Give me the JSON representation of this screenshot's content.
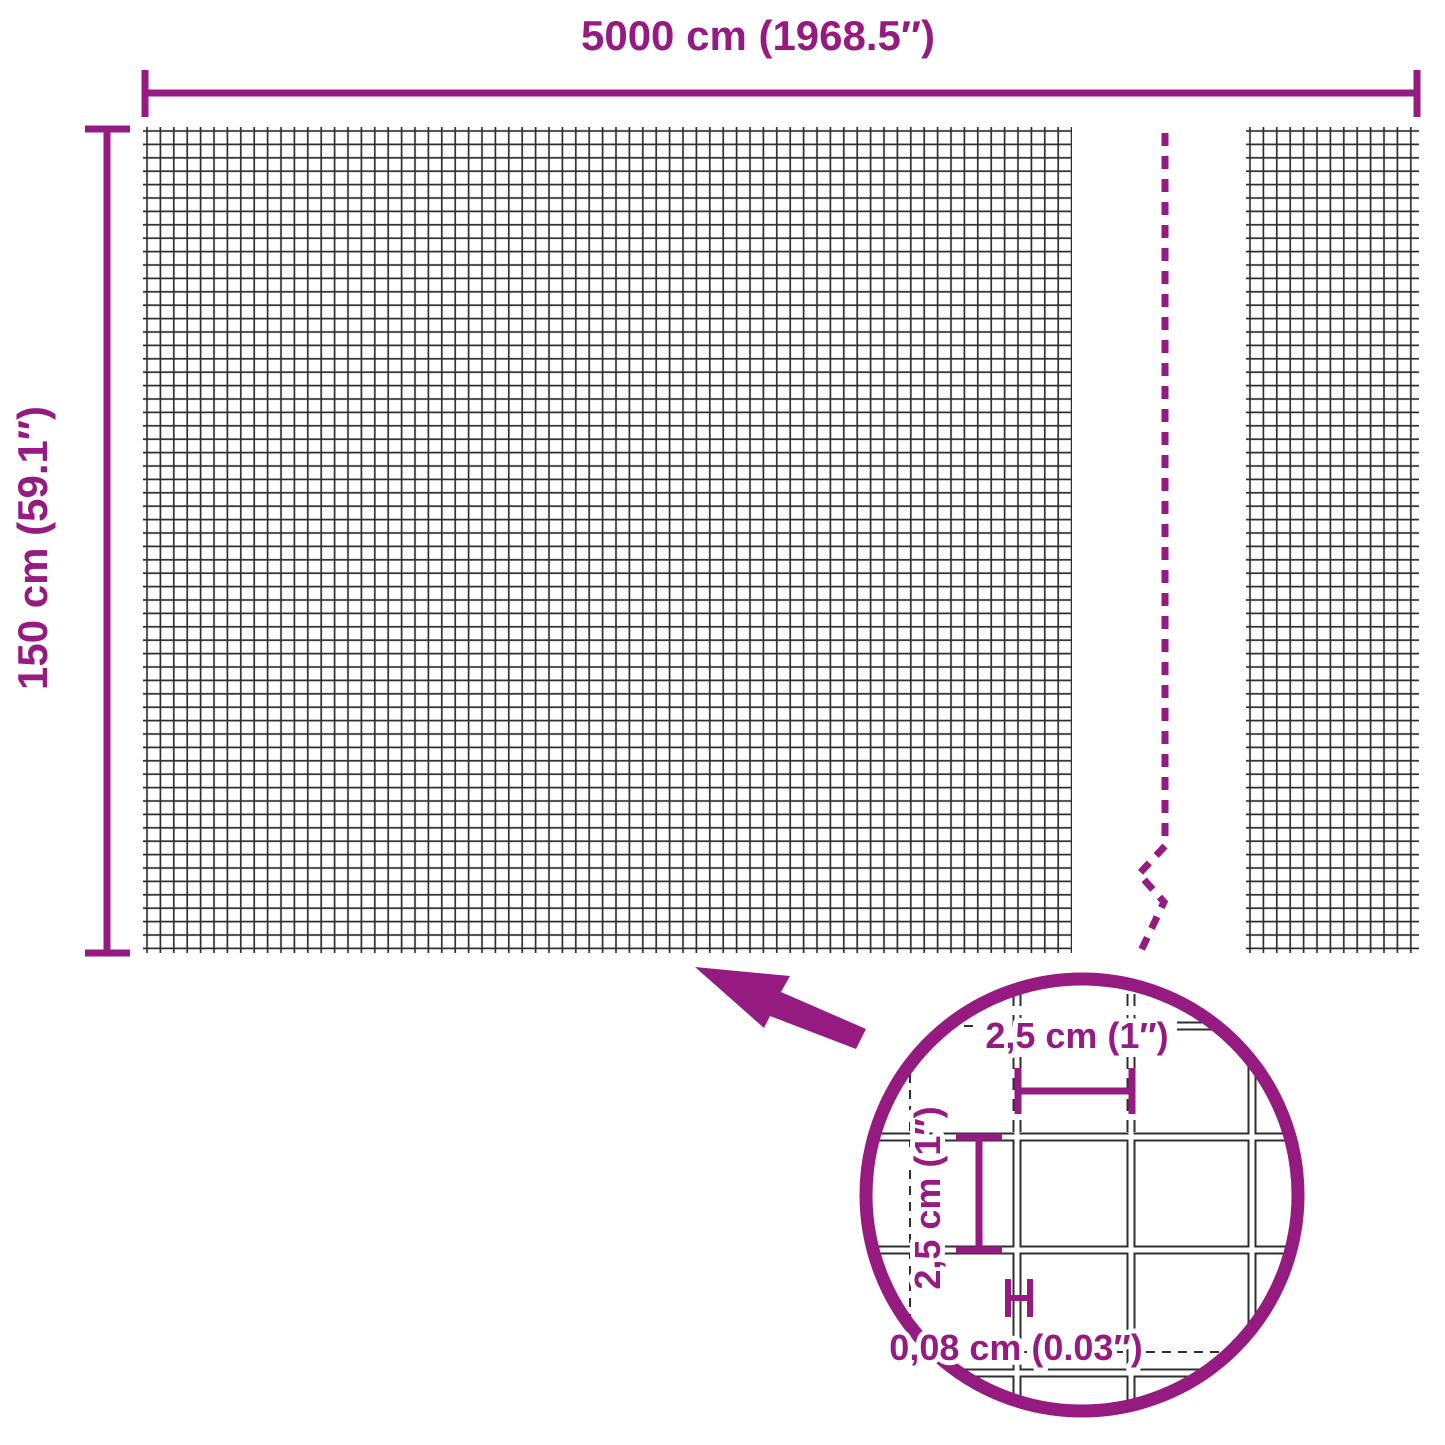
{
  "diagram": {
    "colors": {
      "accent": "#951b81",
      "mesh_line": "#2f2f2f",
      "background": "#ffffff"
    },
    "overall": {
      "width_label": "5000 cm (1968.5″)",
      "height_label": "150 cm (59.1″)"
    },
    "lens": {
      "cell_width_label": "2,5 cm (1″)",
      "cell_height_label": "2,5 cm (1″)",
      "wire_thickness_label": "0,08 cm (0.03″)"
    },
    "measurements": {
      "width_cm": "5000",
      "width_in": "1968.5",
      "height_cm": "150",
      "height_in": "59.1",
      "mesh_cell_cm": "2,5",
      "mesh_cell_in": "1",
      "wire_thickness_cm": "0,08",
      "wire_thickness_in": "0.03"
    }
  }
}
